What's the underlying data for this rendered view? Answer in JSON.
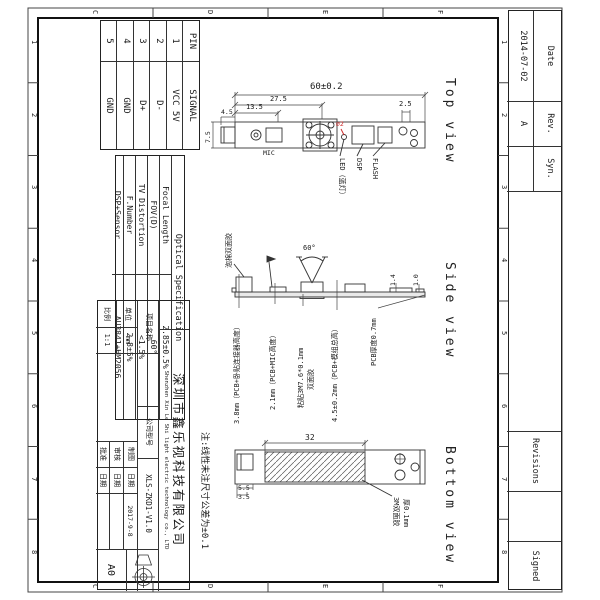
{
  "sheet": {
    "grid_numbers": [
      "1",
      "2",
      "3",
      "4",
      "5",
      "6",
      "7",
      "8"
    ],
    "grid_letters": [
      "C",
      "D",
      "E",
      "F"
    ]
  },
  "revision_strip": {
    "date_label": "Date",
    "date_value": "2014-07-02",
    "rev_label": "Rev.",
    "rev_value": "A",
    "syn_label": "Syn.",
    "revisions_title": "Revisions",
    "signed_label": "Signed"
  },
  "pin_table": {
    "pin_header": "PIN",
    "signal_header": "SIGNAL",
    "rows": [
      {
        "pin": "1",
        "signal": "VCC 5V"
      },
      {
        "pin": "2",
        "signal": "D-"
      },
      {
        "pin": "3",
        "signal": "D+"
      },
      {
        "pin": "4",
        "signal": "GND"
      },
      {
        "pin": "5",
        "signal": "GND"
      }
    ]
  },
  "optical_table": {
    "title": "Optical Specification",
    "rows": [
      [
        "Focal Length",
        "2.85±0.5%"
      ],
      [
        "FOV(D)",
        "60°"
      ],
      [
        "TV Distortion",
        "<1.5%"
      ],
      [
        "F.Number",
        "2.8±5%"
      ],
      [
        "DSP+Sensor",
        "AU3841+HM2056"
      ]
    ]
  },
  "note": "注:线性未注尺寸公差为±0.1",
  "views": {
    "top": {
      "title": "Top view",
      "dims": {
        "overall": "60±0.2",
        "lens_center": "27.5",
        "mic_center": "13.5",
        "hole_offset": "2.5",
        "board_width": "7.5",
        "connector": "4.5",
        "led_dia": "⌀2"
      },
      "labels": {
        "mic": "MIC",
        "led": "LED（蓝灯）",
        "dsp": "DSP",
        "flash": "FLASH"
      }
    },
    "side": {
      "title": "Side view",
      "fov": "60°",
      "h1": "1.4",
      "h2": "1.0",
      "foam": "泡棉双面胶",
      "callout_connector": "3.8mm（PCB+卧贴连接器高度）",
      "callout_mic": "2.1mm（PCB+MIC高度）",
      "callout_tape_1": "粘贴3M7.6*0.1mm",
      "callout_tape_2": "双面胶",
      "callout_total": "4.5±0.2mm（PCB+模组总高）",
      "callout_pcb": "PCB厚度0.7mm"
    },
    "bottom": {
      "title": "Bottom view",
      "tape_width": "32",
      "d1": "5.5",
      "d2": "3.5",
      "tape_label_1": "3M双面胶",
      "tape_label_2": "厚0.1mm"
    }
  },
  "title_block": {
    "company_cn": "深圳市鑫乐视科技有限公司",
    "company_en": "Shenzhen Xin Le Shi light electric technology co., LTD",
    "project_label": "项目名称",
    "model_label": "公司型号",
    "model_value": "XLS-ZKD1-V1.0",
    "unit_label": "单位",
    "unit_value": "mm",
    "scale_label": "比例",
    "scale_value": "1:1",
    "drawn_label": "制图",
    "checked_label": "审核",
    "approved_label": "批准",
    "date_label": "日期",
    "drawn_date": "2017-9-8",
    "sheet_size": "A0"
  }
}
